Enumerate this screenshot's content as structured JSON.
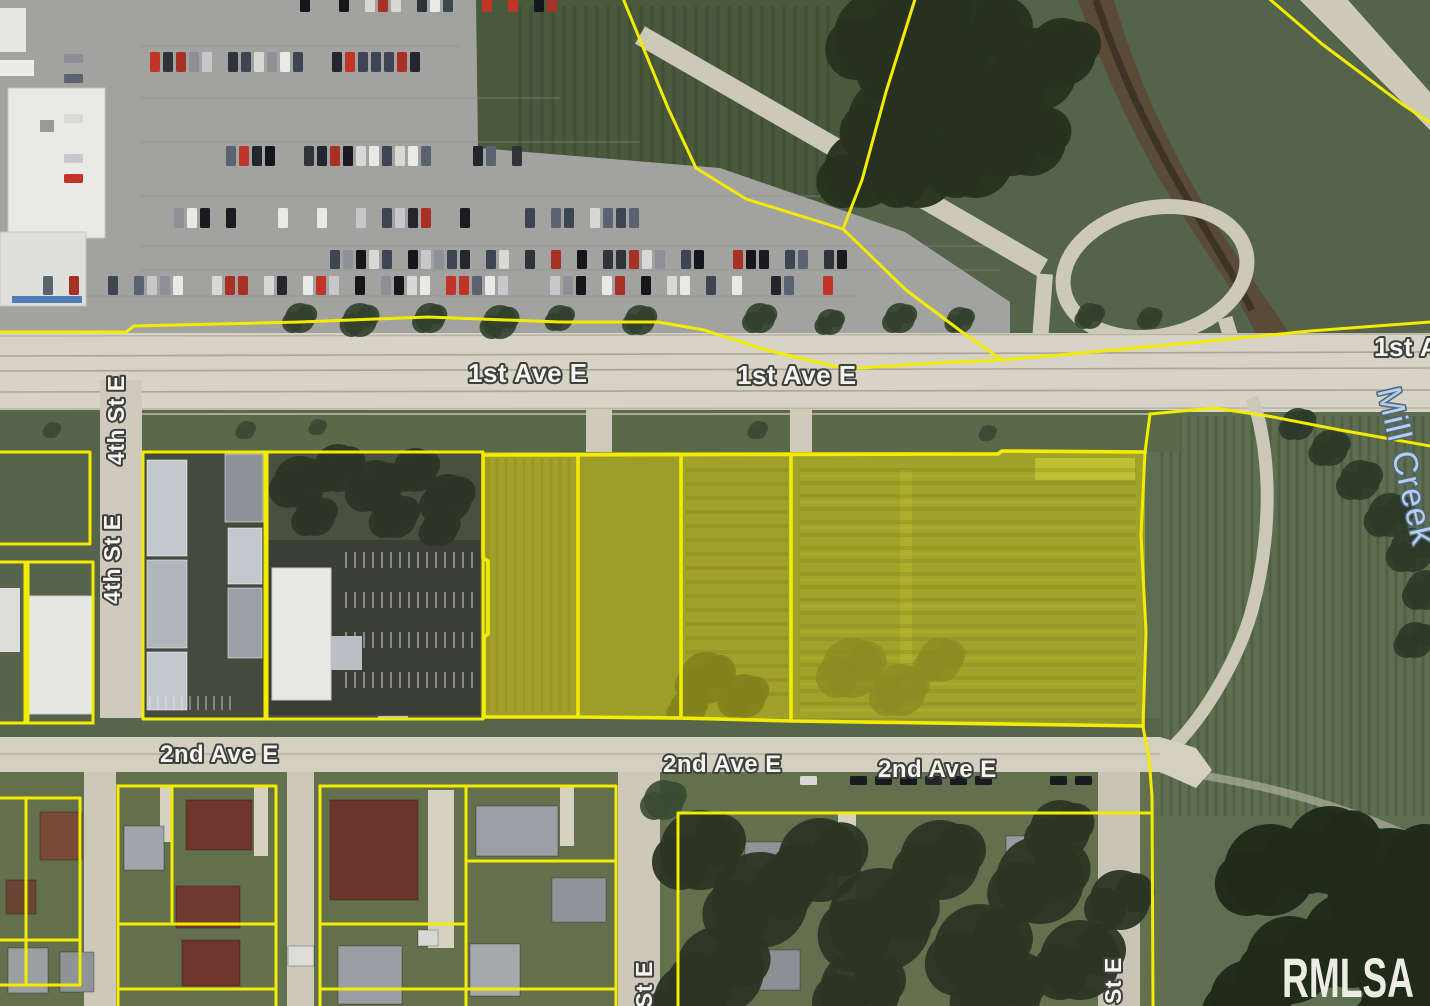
{
  "map": {
    "type": "aerial-parcel-map",
    "labels": [
      {
        "id": "first-ave-left",
        "text": "1st Ave E"
      },
      {
        "id": "first-ave-right",
        "text": "1st Ave E"
      },
      {
        "id": "first-ave-edge",
        "text": "1st A"
      },
      {
        "id": "fourth-st-upper",
        "text": "4th St E"
      },
      {
        "id": "fourth-st-lower",
        "text": "4th St E"
      },
      {
        "id": "second-ave-left",
        "text": "2nd Ave E"
      },
      {
        "id": "second-ave-mid",
        "text": "2nd Ave E"
      },
      {
        "id": "second-ave-right",
        "text": "2nd Ave E"
      },
      {
        "id": "mill-creek",
        "text": "Mill Creek"
      },
      {
        "id": "st-e-bottom-center",
        "text": "St E"
      },
      {
        "id": "st-e-bottom-right",
        "text": "St E"
      }
    ],
    "watermark": "RMLSA",
    "colors": {
      "parcel_boundary": "#f4ec00",
      "parcel_highlight": "rgba(235,224,0,0.40)",
      "street_label": "#f5f5f2",
      "creek_label": "#b4cfec",
      "watermark": "#edece4"
    }
  }
}
